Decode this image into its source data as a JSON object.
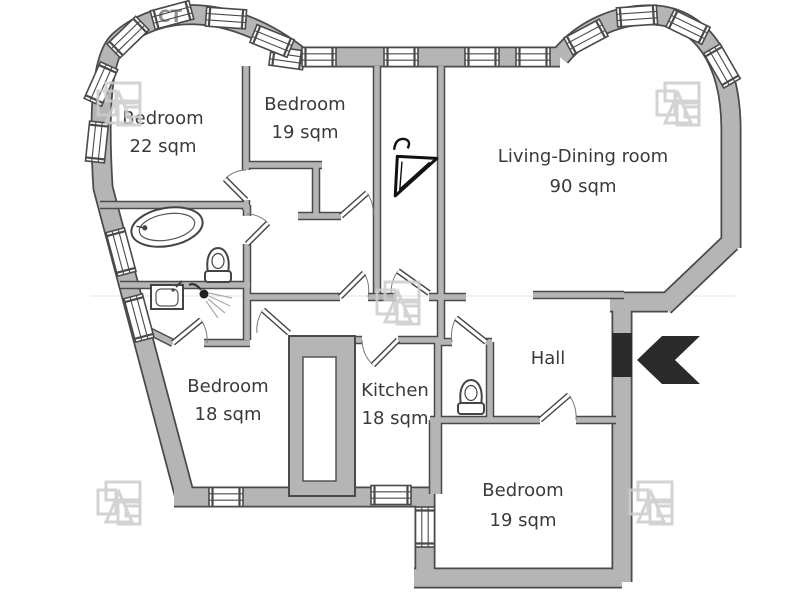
{
  "plan": {
    "title": "apartment floor plan",
    "rooms": [
      {
        "name": "Bedroom",
        "area": "22 sqm"
      },
      {
        "name": "Bedroom",
        "area": "19 sqm"
      },
      {
        "name": "Living-Dining room",
        "area": "90 sqm"
      },
      {
        "name": "Bedroom",
        "area": "18 sqm"
      },
      {
        "name": "Kitchen",
        "area": "18 sqm"
      },
      {
        "name": "Hall",
        "area": ""
      },
      {
        "name": "Bedroom",
        "area": "19 sqm"
      }
    ],
    "fixtures": [
      "bathtub",
      "toilet",
      "shower",
      "sink",
      "toilet",
      "clothes-hanger"
    ],
    "entrance": {
      "symbol": "left-chevron-arrow"
    },
    "watermark_text": "СТ",
    "colors": {
      "background": "#ffffff",
      "wall_fill": "#b5b5b5",
      "wall_outline": "#4a4a4a",
      "entrance_black": "#2a2a2a",
      "label_text": "#3a3a3a",
      "watermark": "#cccccc"
    }
  }
}
